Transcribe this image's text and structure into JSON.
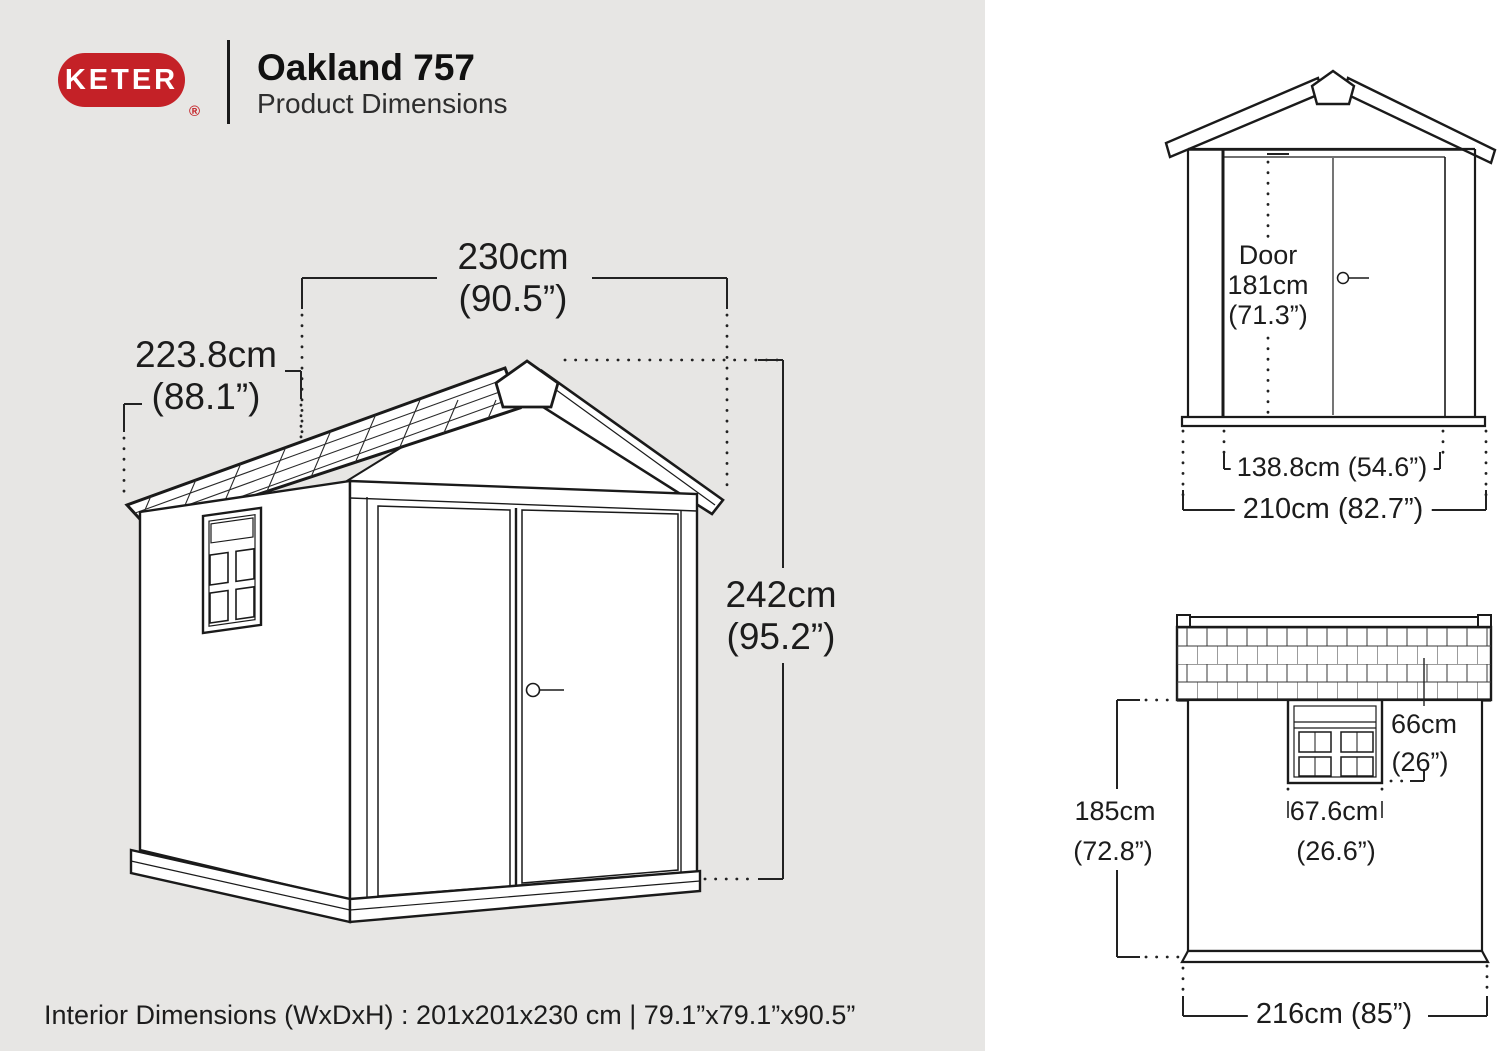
{
  "header": {
    "brand": "KETER",
    "registered": "®",
    "title": "Oakland 757",
    "subtitle": "Product Dimensions"
  },
  "colors": {
    "brand_red": "#c42127",
    "left_panel_bg": "#e7e6e4",
    "right_panel_bg": "#ffffff",
    "line_ink": "#1a1a1a"
  },
  "main_view": {
    "width_cm": "230cm",
    "width_in": "(90.5”)",
    "depth_cm": "223.8cm",
    "depth_in": "(88.1”)",
    "height_cm": "242cm",
    "height_in": "(95.2”)"
  },
  "front_view": {
    "door_label_line1": "Door",
    "door_label_line2": "181cm",
    "door_label_line3": "(71.3”)",
    "door_width": "138.8cm (54.6”)",
    "overall_width": "210cm (82.7”)"
  },
  "side_view": {
    "window_height_cm": "66cm",
    "window_height_in": "(26”)",
    "wall_height_cm": "185cm",
    "wall_height_in": "(72.8”)",
    "window_width_cm": "67.6cm",
    "window_width_in": "(26.6”)",
    "overall_depth": "216cm (85”)"
  },
  "footer": {
    "interior_dimensions": "Interior Dimensions (WxDxH) : 201x201x230 cm | 79.1”x79.1”x90.5”"
  }
}
